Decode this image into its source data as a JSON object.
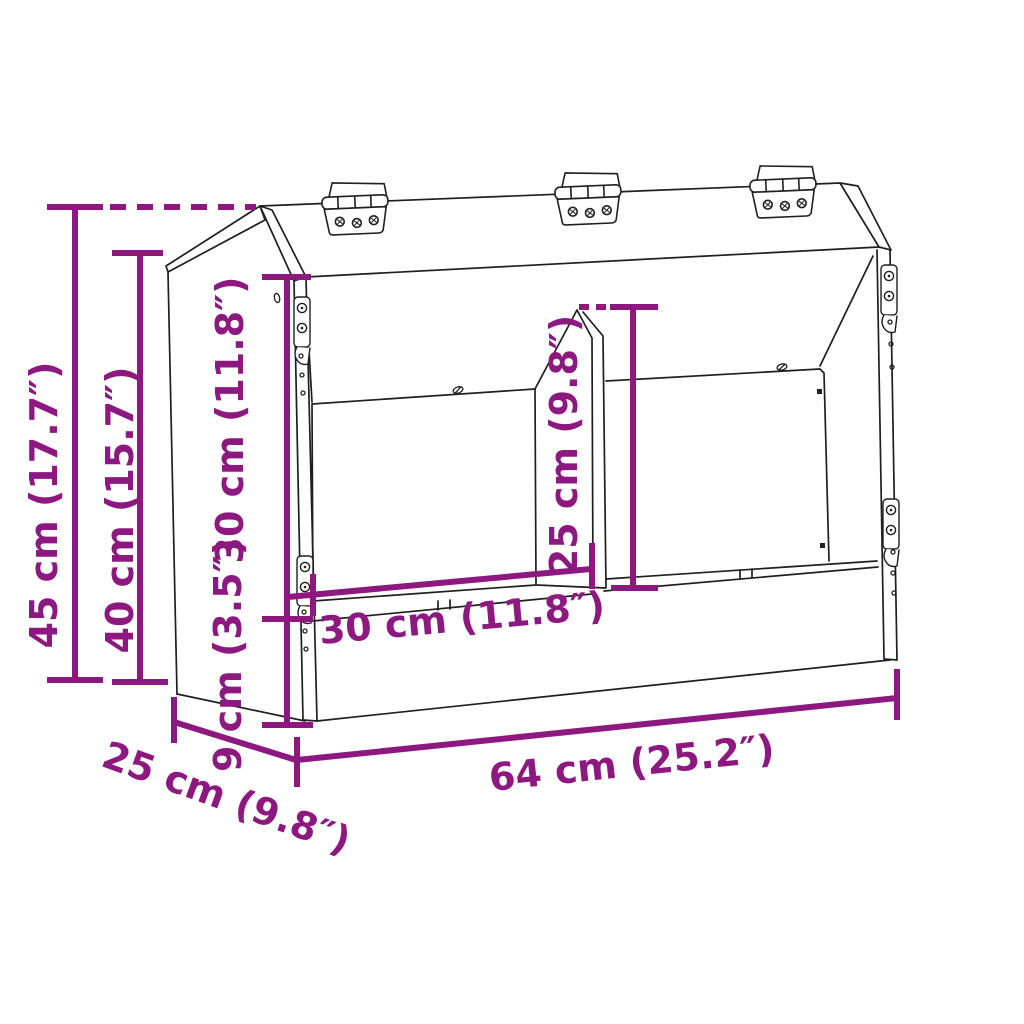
{
  "colors": {
    "background": "#ffffff",
    "line": "#1f1f1f",
    "dimension": "#8D1980"
  },
  "dimensions": {
    "overall_height": "45 cm (17.7″)",
    "front_height": "40 cm (15.7″)",
    "opening_height": "30 cm (11.8″)",
    "lip_height": "9 cm (3.5″)",
    "divider_height": "25 cm (9.8″)",
    "compartment_width": "30 cm (11.8″)",
    "overall_width": "64 cm (25.2″)",
    "depth": "25 cm (9.8″)"
  }
}
